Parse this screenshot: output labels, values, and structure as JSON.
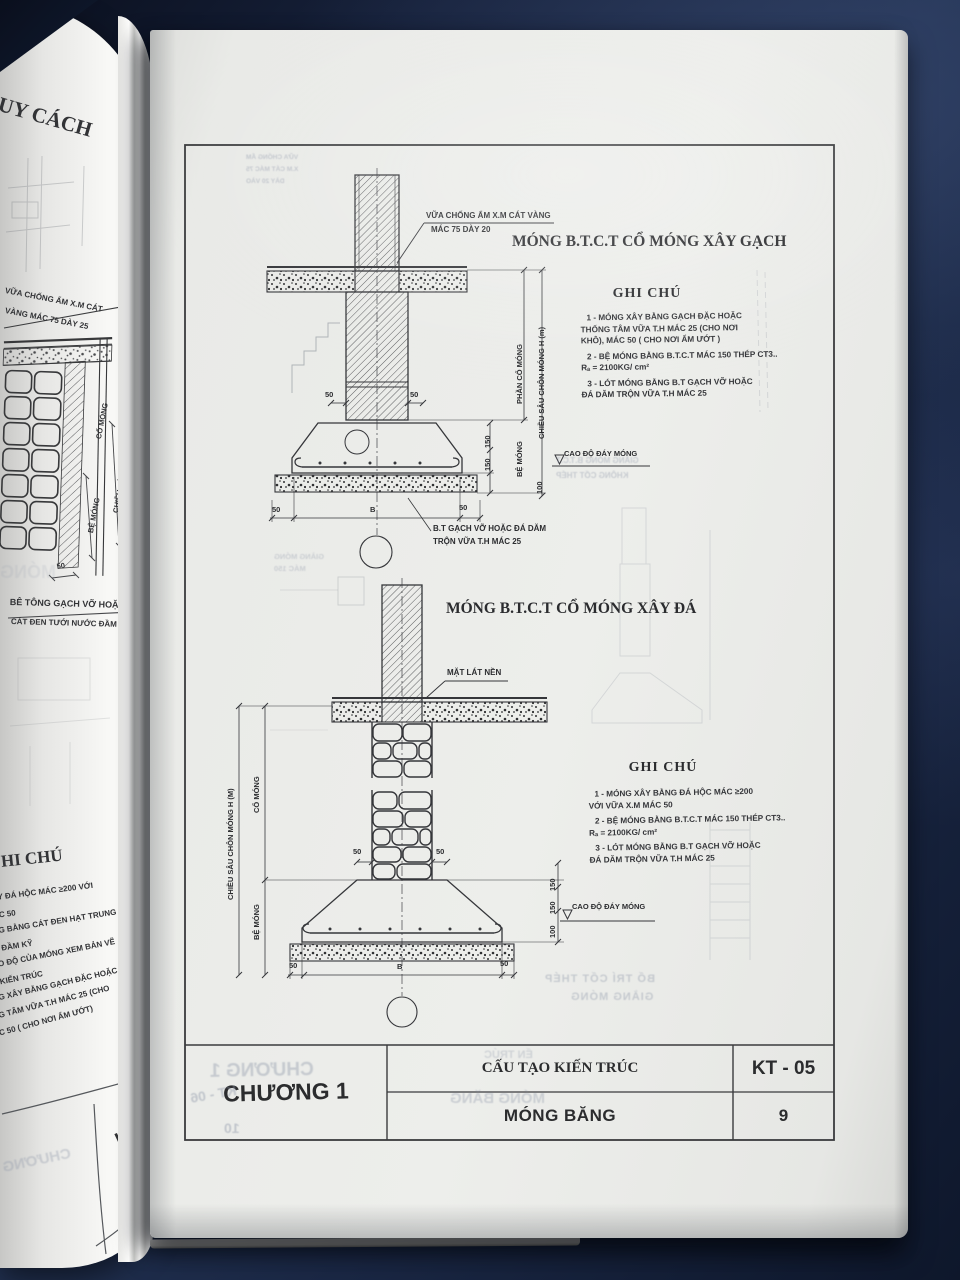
{
  "left_page": {
    "heading": "UY CÁCH",
    "callout_line1": "VỮA CHỐNG ẨM X.M CÁT",
    "callout_line2": "VÀNG MÁC 75 DÀY 25",
    "dim_co_mong": "CỔ MÓNG",
    "dim_chieu_sau": "CHIỀU SÂU CHÔN MÓNG",
    "dim_be_mong": "BỆ MÓNG",
    "dim_50": "50",
    "lot_line1": "BÊ TÔNG GẠCH VỠ HOẶC",
    "lot_line2": "CÁT ĐEN TƯỚI NƯỚC ĐẦM KỸ",
    "ghi_chu": "HI CHÚ",
    "notes": [
      "XÂY ĐÁ HỘC MÁC ≥200 VỚI",
      "MÁC 50",
      "ÓNG BẰNG CÁT ĐEN HẠT TRUNG",
      "ỚC ĐẦM KỸ",
      "CAO ĐỘ CỦA MÓNG XEM BẢN VẼ",
      "VÀ KIẾN TRÚC",
      "ÔNG XÂY BẰNG GẠCH ĐẶC HOẶC (CHO",
      "ỐNG TÂM VỮA T.H MÁC 25 (CHO",
      "MÁC 50 ( CHO NƠI ẨM ƯỚT)"
    ],
    "code": "KT - 04",
    "page": "8",
    "ghost_chuong": "CHƯƠNG",
    "ghost_mong": "MÓNG"
  },
  "sheet": {
    "dims": {
      "d50": "50",
      "d150": "150",
      "d100": "100",
      "dB": "B"
    },
    "drawing1": {
      "title": "MÓNG B.T.C.T CỔ MÓNG XÂY GẠCH",
      "callout_line1": "VỮA CHỐNG ẨM X.M CÁT VÀNG",
      "callout_line2": "MÁC 75 DÀY 20",
      "dim_phan_co_mong": "PHẦN CỔ MÓNG",
      "dim_chieu_sau": "CHIỀU SÂU CHÔN MÓNG H (m)",
      "dim_be_mong": "BỆ MÓNG",
      "cao_do": "CAO ĐỘ ĐÁY MÓNG",
      "lot_line1": "B.T GẠCH VỠ HOẶC ĐÁ DĂM",
      "lot_line2": "TRỘN VỮA T.H MÁC 25",
      "ghi_chu": "GHI CHÚ",
      "notes": [
        "1 -  MÓNG XÂY BẰNG GẠCH ĐẶC HOẶC",
        "THỐNG TÂM VỮA T.H MÁC 25 (CHO NƠI",
        "KHÔ), MÁC 50 ( CHO NƠI ẨM ƯỚT )",
        "2 -  BỆ MÓNG BẰNG B.T.C.T MÁC 150 THÉP CT3..",
        "Rₐ = 2100KG/ cm²",
        "3 -  LÓT MÓNG BẰNG B.T GẠCH VỠ HOẶC",
        "ĐÁ DĂM TRỘN VỮA T.H MÁC 25"
      ]
    },
    "drawing2": {
      "title": "MÓNG B.T.C.T CỔ MÓNG XÂY ĐÁ",
      "mat_lat_nen": "MẶT LÁT NỀN",
      "dim_chieu_sau": "CHIỀU SÂU CHÔN MÓNG H (M)",
      "dim_co_mong": "CỔ MÓNG",
      "dim_be_mong": "BỆ MÓNG",
      "cao_do": "CAO ĐỘ ĐÁY MÓNG",
      "ghi_chu": "GHI CHÚ",
      "notes": [
        "1 -  MÓNG XÂY BẰNG ĐÁ HỘC MÁC ≥200",
        "VỚI VỮA X.M MÁC 50",
        "2 -  BỆ MÓNG BẰNG B.T.C.T MÁC 150 THÉP CT3..",
        "Rₐ = 2100KG/ cm²",
        "3 -  LÓT MÓNG BẰNG B.T GẠCH VỠ HOẶC",
        "ĐÁ DĂM TRỘN VỮA T.H MÁC 25"
      ]
    },
    "title_block": {
      "chapter": "CHƯƠNG 1",
      "series": "CẤU TẠO KIẾN TRÚC",
      "sheet_title": "MÓNG BĂNG",
      "code": "KT - 05",
      "page": "9"
    },
    "ghosts": {
      "top1": "VỮA CHỐNG ẨM",
      "top2": "X.M CÁT MÁC 75",
      "top3": "DÀY 20 VÀO",
      "mid1": "GIẰNG MÓNG B.T.C.T",
      "mid2": "KHÔNG CỐT THÉP",
      "left1": "GIẰNG MÓNG",
      "left2": "MÁC 150",
      "bottom1": "BỐ TRÍ CỐT THÉP",
      "bottom2": "GIẰNG MÓNG",
      "tb_chapter": "CHƯƠNG 1",
      "tb_code": "KT - 06",
      "tb_page": "10",
      "tb_title": "MÓNG BĂNG",
      "tb_series": "ẾN TRÚC"
    }
  }
}
